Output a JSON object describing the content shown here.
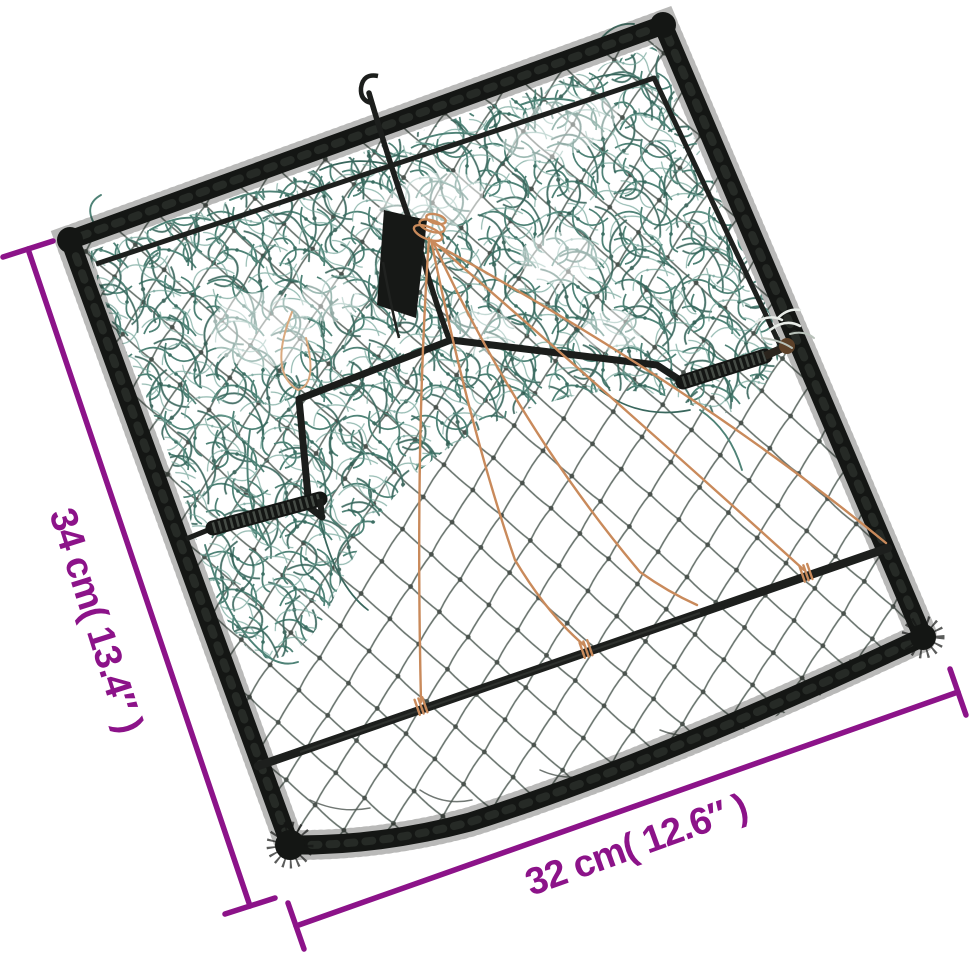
{
  "meta": {
    "description": "Product photo of a spring-loaded bird clap-net trap: black rope-wrapped square frame, fine dark mesh base, bunched green netting, two coil springs, central trigger rod with orange tie strings, annotated with measurement lines"
  },
  "annotations": {
    "height_label": "34 cm( 13.4″ )",
    "width_label": "32 cm( 12.6″ )"
  },
  "colors": {
    "dimension_purple": "#8c1389",
    "net_green": "#4e8276",
    "net_green_dark": "#39675d",
    "string_orange": "#c98a5b",
    "frame_black": "#141614",
    "mesh_gray": "#68736d",
    "background": "#ffffff"
  }
}
